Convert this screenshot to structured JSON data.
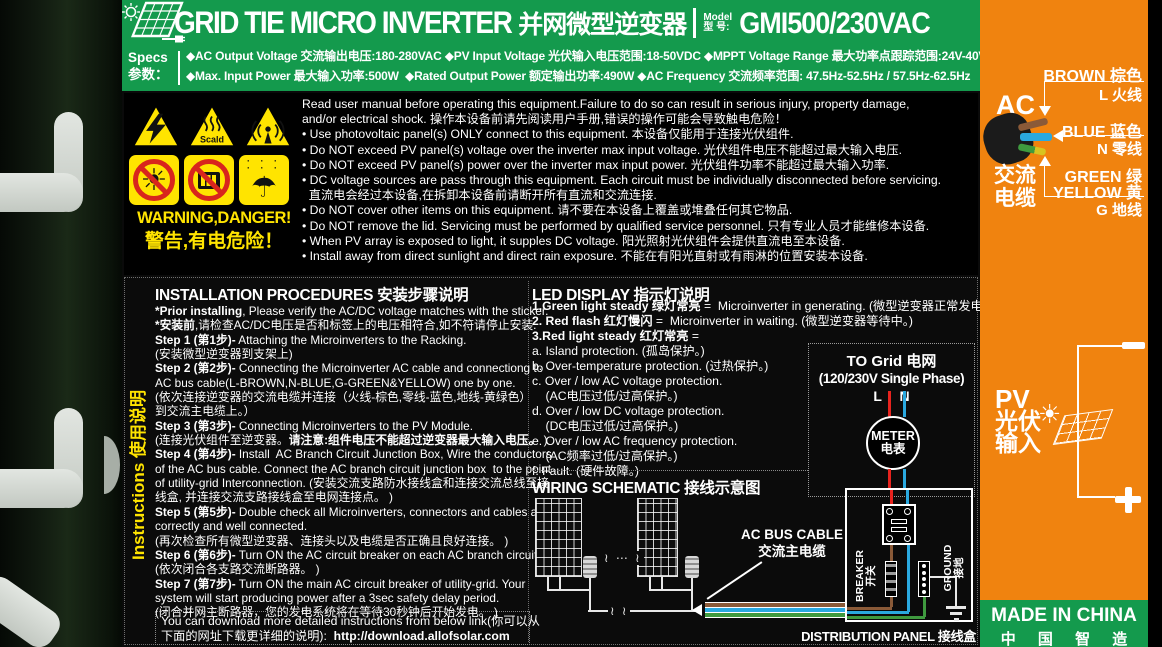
{
  "colors": {
    "green": "#149a4d",
    "orange": "#f0830f",
    "yellow": "#ffe400",
    "ban_red": "#d8251d",
    "wire_brown": "#8a5a38",
    "wire_blue": "#2aa9e0",
    "wire_green": "#3f9a3f",
    "line_red": "#e8231e"
  },
  "header": {
    "brand_en": "GRID TIE MICRO INVERTER",
    "brand_zh": "并网微型逆变器",
    "model_label_1": "Model",
    "model_label_2": "型 号:",
    "model_value": "GMI500/230VAC"
  },
  "specs": {
    "label_1": "Specs",
    "label_2": "参数：",
    "lines": [
      "◆AC Output Voltage 交流输出电压:180-280VAC ◆PV Input Voltage 光伏输入电压范围:18-50VDC ◆MPPT Voltage Range 最大功率点跟踪范围:24V-40V",
      "◆Max. Input Power 最大输入功率:500W  ◆Rated Output Power 额定输出功率:490W ◆AC Frequency 交流频率范围: 47.5Hz-52.5Hz / 57.5Hz-62.5Hz"
    ]
  },
  "warning": {
    "heading_1": "WARNING,DANGER!",
    "heading_2": "警告,有电危险！",
    "scald_label": "Scald",
    "icons": [
      "high-voltage",
      "scald",
      "rf-radiation",
      "no-direct-sunlight",
      "no-cover",
      "keep-dry"
    ],
    "lines": [
      "Read user manual before operating this equipment.Failure to do so can result in serious injury, property damage,",
      "and/or electrical shock. 操作本设备前请先阅读用户手册,错误的操作可能会导致触电危险！",
      "• Use photovoltaic panel(s) ONLY connect to this equipment. 本设备仅能用于连接光伏组件.",
      "• Do NOT exceed PV panel(s) voltage over the inverter max input voltage. 光伏组件电压不能超过最大输入电压.",
      "• Do NOT exceed PV panel(s) power over the inverter max input power. 光伏组件功率不能超过最大输入功率.",
      "• DC voltage sources are pass through this equipment. Each circuit must be individually disconnected before servicing.",
      "  直流电会经过本设备,在拆卸本设备前请断开所有直流和交流连接.",
      "• Do NOT cover other items on this equipment. 请不要在本设备上覆盖或堆叠任何其它物品.",
      "• Do NOT remove the lid. Servicing must be performed by qualified service personnel. 只有专业人员才能维修本设备.",
      "• When PV array is exposed to light, it supples DC voltage. 阳光照射光伏组件会提供直流电至本设备.",
      "• Install away from direct sunlight and direct rain exposure. 不能在有阳光直射或有雨淋的位置安装本设备."
    ]
  },
  "sidebar": {
    "label": "Instructions 使用说明"
  },
  "installation": {
    "title": "INSTALLATION PROCEDURES 安装步骤说明",
    "lines": [
      [
        {
          "t": "*Prior installing",
          "b": 1
        },
        {
          "t": ", Please verify the AC/DC voltage matches with the sticker."
        }
      ],
      [
        {
          "t": "*安装前",
          "b": 1
        },
        {
          "t": ",请检查AC/DC电压是否和标签上的电压相符合,如不符请停止安装."
        }
      ],
      [
        {
          "t": "Step 1 (第1步)-",
          "b": 1
        },
        {
          "t": " Attaching the Microinverters to the Racking."
        }
      ],
      [
        {
          "t": "(安装微型逆变器到支架上)"
        }
      ],
      [
        {
          "t": "Step 2 (第2步)-",
          "b": 1
        },
        {
          "t": " Connecting the Microinverter AC cable and connectiong to"
        }
      ],
      [
        {
          "t": "AC bus cable(L-BROWN,N-BLUE,G-GREEN&YELLOW) one by one."
        }
      ],
      [
        {
          "t": "(依次连接逆变器的交流电缆并连接（火线-棕色,零线-蓝色,地线-黄绿色）"
        }
      ],
      [
        {
          "t": "到交流主电缆上。）"
        }
      ],
      [
        {
          "t": "Step 3 (第3步)-",
          "b": 1
        },
        {
          "t": " Connecting Microinverters to the PV Module."
        }
      ],
      [
        {
          "t": "(连接光伏组件至逆变器。"
        },
        {
          "t": "请注意:组件电压不能超过逆变器最大输入电压。",
          "b": 1
        },
        {
          "t": " )"
        }
      ],
      [
        {
          "t": "Step 4 (第4步)-",
          "b": 1
        },
        {
          "t": " Install  AC Branch Circuit Junction Box, Wire the conductors"
        }
      ],
      [
        {
          "t": "of the AC bus cable. Connect the AC branch circuit junction box  to the point"
        }
      ],
      [
        {
          "t": "of utility-grid Interconnection. (安装交流支路防水接线盒和连接交流总线至接"
        }
      ],
      [
        {
          "t": "线盒, 并连接交流支路接线盒至电网连接点。 )"
        }
      ],
      [
        {
          "t": "Step 5 (第5步)-",
          "b": 1
        },
        {
          "t": " Double check all Microinverters, connectors and cables are"
        }
      ],
      [
        {
          "t": "correctly and well connected."
        }
      ],
      [
        {
          "t": "(再次检查所有微型逆变器、连接头以及电缆是否正确且良好连接。 )"
        }
      ],
      [
        {
          "t": "Step 6 (第6步)-",
          "b": 1
        },
        {
          "t": " Turn ON the AC circuit breaker on each AC branch circuit."
        }
      ],
      [
        {
          "t": "(依次闭合各支路交流断路器。 )"
        }
      ],
      [
        {
          "t": "Step 7 (第7步)-",
          "b": 1
        },
        {
          "t": " Turn ON the main AC circuit breaker of utility-grid. Your"
        }
      ],
      [
        {
          "t": "system will start producing power after a 3sec safety delay period."
        }
      ],
      [
        {
          "t": "(闭合并网主断路器，您的发电系统将在等待30秒钟后开始发电。 )"
        }
      ]
    ],
    "download": [
      [
        {
          "t": "You can download more detailed instructions from below link(你可以从"
        }
      ],
      [
        {
          "t": "下面的网址下载更详细的说明):  "
        },
        {
          "t": "http://download.allofsolar.com",
          "b": 1
        }
      ]
    ]
  },
  "led": {
    "title": "LED DISPLAY 指示灯说明",
    "lines": [
      [
        {
          "t": "1.Green light steady 绿灯常亮",
          "b": 1
        },
        {
          "t": " =  Microinverter in generating. (微型逆变器正常发电中。)"
        }
      ],
      [
        {
          "t": "2. Red flash 红灯慢闪",
          "b": 1
        },
        {
          "t": " =  Microinverter in waiting. (微型逆变器等待中。)"
        }
      ],
      [
        {
          "t": "3.Red light steady 红灯常亮",
          "b": 1
        },
        {
          "t": " ="
        }
      ],
      [
        {
          "t": "a. Island protection. (孤岛保护。)"
        }
      ],
      [
        {
          "t": "b. Over-temperature protection. (过热保护。)"
        }
      ],
      [
        {
          "t": "c. Over / low AC voltage protection."
        }
      ],
      [
        {
          "t": "    (AC电压过低/过高保护。)"
        }
      ],
      [
        {
          "t": "d. Over / low DC voltage protection."
        }
      ],
      [
        {
          "t": "    (DC电压过低/过高保护。)"
        }
      ],
      [
        {
          "t": "e. Over / low AC frequency protection."
        }
      ],
      [
        {
          "t": "    (AC频率过低/过高保护。)"
        }
      ],
      [
        {
          "t": "f. Fault. (硬件故障。)"
        }
      ]
    ]
  },
  "wiring": {
    "title": "WIRING SCHEMATIC 接线示意图",
    "ac_bus_1": "AC BUS CABLE",
    "ac_bus_2": "交流主电缆",
    "breaker_1": "BREAKER",
    "breaker_2": "开关",
    "ground_1": "GROUND",
    "ground_2": "接地",
    "dist_panel": "DISTRIBUTION PANEL 接线盒"
  },
  "grid_box": {
    "line1": "TO Grid 电网",
    "line2": "(120/230V Single Phase)",
    "ln": "L N",
    "meter_1": "METER",
    "meter_2": "电表"
  },
  "panel_right": {
    "ac": "AC",
    "ac_cable_1": "交流",
    "ac_cable_2": "电缆",
    "brown_1": "BROWN 棕色",
    "brown_2": "L 火线",
    "blue_1": "BLUE 蓝色",
    "blue_2": "N 零线",
    "green_1": "GREEN  绿",
    "green_2": "YELLOW 黄",
    "green_3": "G 地线",
    "pv_1": "PV",
    "pv_2": "光伏",
    "pv_3": "输入",
    "minus": "−",
    "plus": "+",
    "made_1": "MADE IN CHINA",
    "made_2": "中 国 智 造"
  }
}
